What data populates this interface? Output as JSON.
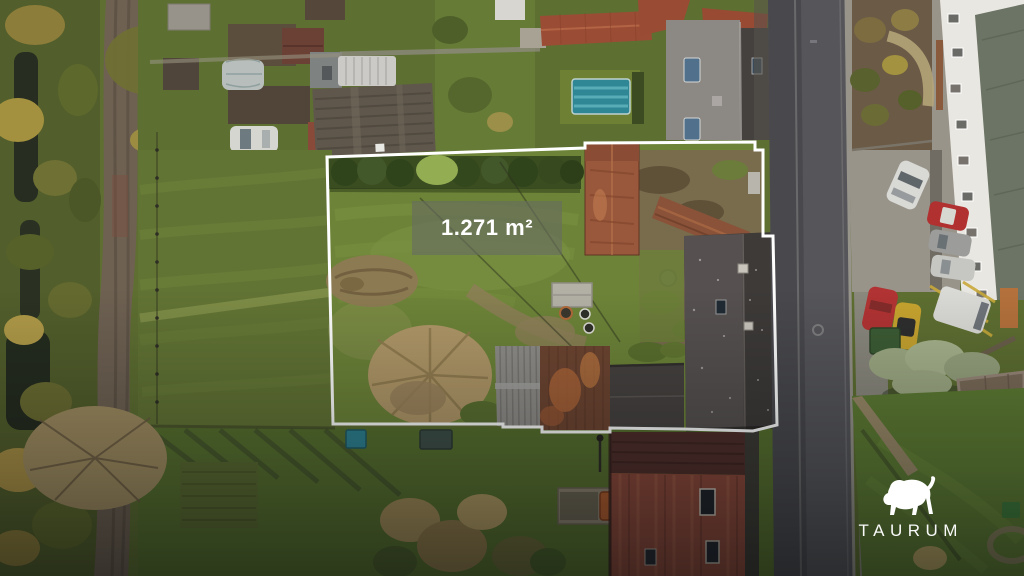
{
  "overlay": {
    "area_label": "1.271 m²",
    "boundary_color": "#ffffff",
    "label_box_color": "rgba(104,108,97,0.62)"
  },
  "brand": {
    "name": "TAURUM",
    "logo_icon": "bull-icon",
    "color": "#ffffff"
  },
  "scene_colors": {
    "meadow_green": "#627434",
    "plot_grass": "#6d8438",
    "hedge_dark": "#3a4d20",
    "dirt_lane": "#6e6152",
    "asphalt_road": "#4a4a4e",
    "house_roof_dark": "#3d3a38",
    "barn_roof_rust": "#99583c",
    "red_tile_roof": "#8a4839",
    "pool_teal": "#2f8694",
    "white_building": "#e9e7e1"
  }
}
